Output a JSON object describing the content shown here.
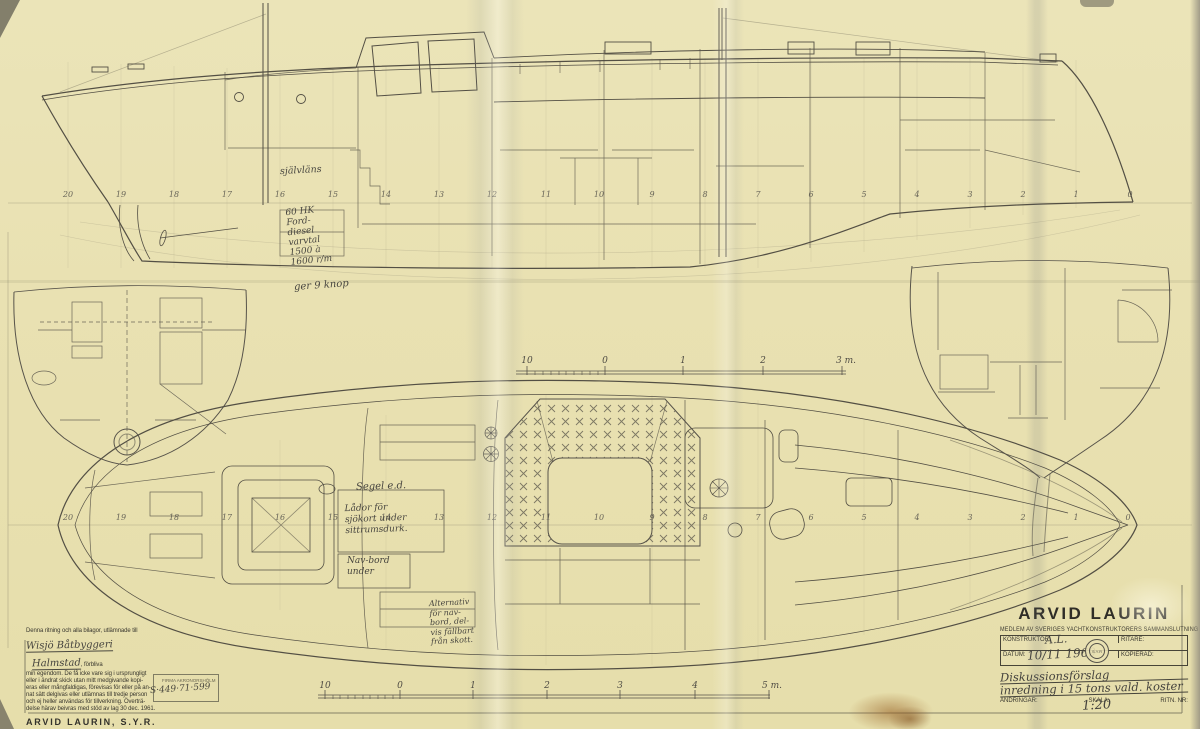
{
  "title_block": {
    "name": "ARVID LAURIN",
    "membership_line": "MEDLEM AV SVERIGES YACHTKONSTRUKTÖRERS SAMMANSLUTNING",
    "konstruktor_label": "KONSTRUKTÖR:",
    "konstruktor_value": "A.L.",
    "ritare_label": "RITARE:",
    "datum_label": "DATUM:",
    "datum_value": "10/11 1969",
    "kopierad_label": "KOPIERAD:",
    "andringar_label": "ÄNDRINGAR:",
    "skala_label": "SKALA:",
    "ritn_nr_label": "RITN. NR:",
    "seal_text": "S.Y.R",
    "drawing_title_line1": "Diskussionsförslag",
    "drawing_title_line2": "inredning i 15 tons vald. koster",
    "scale_value": "1:20"
  },
  "legal_block": {
    "intro": "Denna ritning och alla bilagor, utlämnade till",
    "recipient_line1": "Wisjö Båtbyggeri",
    "recipient_line2": "Halmstad",
    "after_recipient": ", förbliva",
    "body_lines": [
      "min egendom. De få icke vare sig i ursprungligt",
      "eller i ändrat skick utan mitt medgivande kopi-",
      "eras eller mångfaldigas, förevisas för eller på an-",
      "nat sätt delgivas eller utlämnas till tredje person",
      "och ej heller användas för tillverkning. Överträ-",
      "delse härav beivras med stöd av lag 30 dec. 1961."
    ],
    "signature": "ARVID LAURIN, S.Y.R.",
    "stamp_line1": "FIRMA AKRONORSHÖLM",
    "stamp_line2": "S·449·71·599"
  },
  "annotations": {
    "sjalvlans": "självläns",
    "engine_lines": [
      "60 HK",
      "Ford-",
      "diesel",
      "varvtal",
      "1500 à",
      "1600 r/m"
    ],
    "engine_result": "ger 9 knop",
    "segel": "Segel e.d.",
    "lador_lines": [
      "Lådor för",
      "sjökort under",
      "sittrumsdurk."
    ],
    "navbord_lines": [
      "Nav-bord",
      "under"
    ],
    "alternativ_lines": [
      "Alternativ",
      "för nav-",
      "bord, del-",
      "vis fällbart",
      "från skott."
    ]
  },
  "stations_profile": [
    "20",
    "19",
    "18",
    "17",
    "16",
    "15",
    "14",
    "13",
    "12",
    "11",
    "10",
    "9",
    "8",
    "7",
    "6",
    "5",
    "4",
    "3",
    "2",
    "1",
    "0"
  ],
  "stations_plan": [
    "20",
    "19",
    "18",
    "17",
    "16",
    "15",
    "14",
    "13",
    "12",
    "11",
    "10",
    "9",
    "8",
    "7",
    "6",
    "5",
    "4",
    "3",
    "2",
    "1",
    "0"
  ],
  "scale_bar_upper": {
    "labels": [
      "10",
      "0",
      "1",
      "2",
      "3 m."
    ]
  },
  "scale_bar_lower": {
    "labels": [
      "10",
      "0",
      "1",
      "2",
      "3",
      "4",
      "5 m."
    ]
  }
}
